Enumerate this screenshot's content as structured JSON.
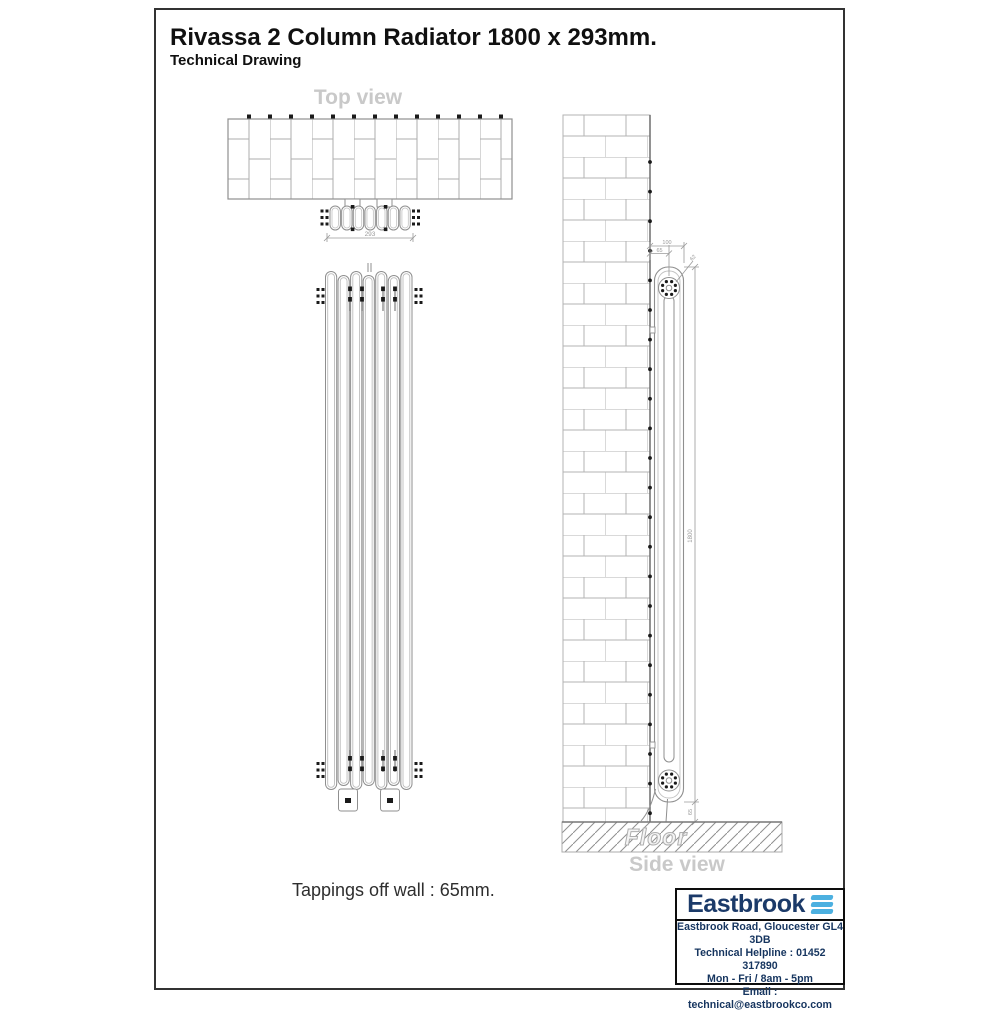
{
  "page": {
    "title": "Rivassa 2 Column Radiator 1800 x 293mm.",
    "subtitle": "Technical Drawing"
  },
  "views": {
    "top": {
      "label": "Top view",
      "width_dim": "293"
    },
    "side": {
      "label": "Side view",
      "floor_label": "Floor",
      "height_dim": "1800",
      "depth_dim": "100",
      "tapping_dim": "65",
      "collar_dim": "62",
      "floor_gap_dim": "65"
    }
  },
  "note": {
    "tappings": "Tappings off wall : 65mm."
  },
  "footer": {
    "brand": "Eastbrook",
    "address": "Eastbrook Road, Gloucester GL4 3DB",
    "helpline": "Technical Helpline : 01452 317890",
    "hours": "Mon - Fri / 8am - 5pm",
    "email": "Email : technical@eastbrookco.com"
  },
  "colors": {
    "brand_navy": "#1b3a69",
    "brand_blue": "#4cb0e0",
    "line_gray": "#8f8f8f",
    "label_gray": "#c9c9c9",
    "dim_gray": "#9a9a9a"
  }
}
